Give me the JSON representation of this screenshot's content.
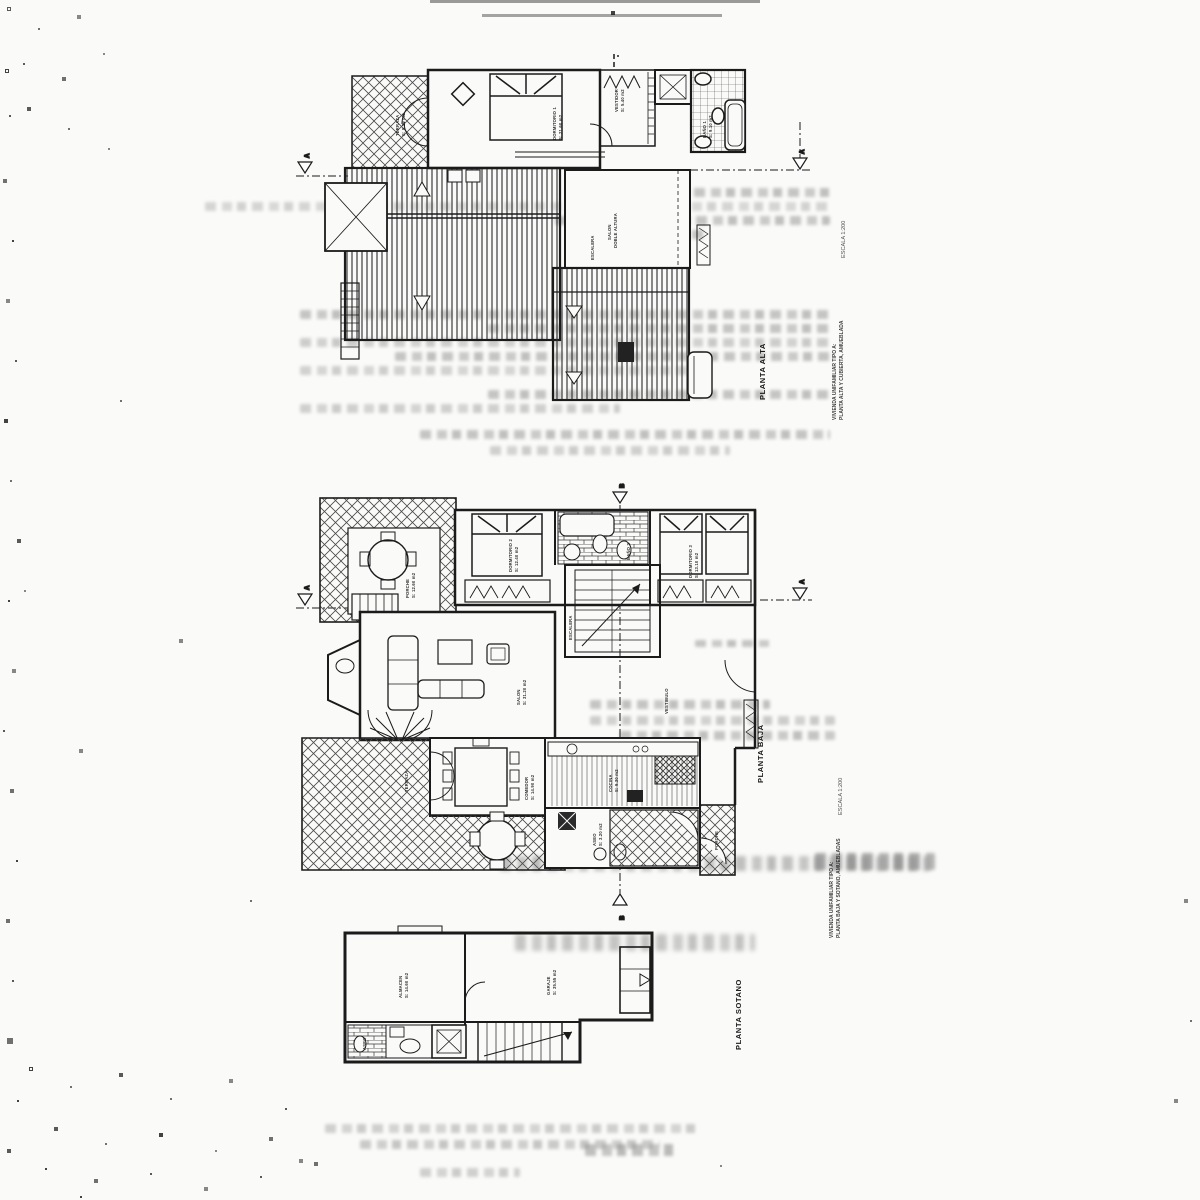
{
  "colors": {
    "ink": "#1b1b1b",
    "paper": "#fafaf8",
    "ghost": "#8f8f8f"
  },
  "markers": {
    "a": "A",
    "b": "B"
  },
  "plans": {
    "alta": {
      "caption": "PLANTA ALTA",
      "escala": "ESCALA 1:200",
      "title1": "VIVIENDA UNIFAMILIAR TIPO A:",
      "title2": "PLANTA ALTA Y CUBIERTA, AMUEBLADA",
      "rooms": {
        "terraza": {
          "name": "TERRAZA",
          "area": "S: 9.20 m2"
        },
        "dormitorio1": {
          "name": "DORMITORIO 1",
          "area": "S: 21.60 m2"
        },
        "vestidor": {
          "name": "VESTIDOR",
          "area": "S: 5.40 m2"
        },
        "bano1": {
          "name": "BAÑO 1",
          "area": "S: 9.10 m2"
        },
        "salon": {
          "name": "SALON",
          "area": "DOBLE ALTURA"
        },
        "escalera": {
          "name": "ESCALERA",
          "area": ""
        }
      }
    },
    "baja": {
      "caption": "PLANTA BAJA",
      "escala": "ESCALA 1:200",
      "title1": "VIVIENDA UNIFAMILIAR TIPO A:",
      "title2": "PLANTA BAJA Y SOTANO, AMUEBLADAS",
      "rooms": {
        "porche": {
          "name": "PORCHE",
          "area": "S: 12.60 m2"
        },
        "dormitorio2": {
          "name": "DORMITORIO 2",
          "area": "S: 12.40 m2"
        },
        "bano2": {
          "name": "BAÑO 2",
          "area": "S: 5.10 m2"
        },
        "dormitorio3": {
          "name": "DORMITORIO 3",
          "area": "S: 13.10 m2"
        },
        "salon": {
          "name": "SALON",
          "area": "S: 31.20 m2"
        },
        "comedor": {
          "name": "COMEDOR",
          "area": "S: 14.90 m2"
        },
        "cocina": {
          "name": "COCINA",
          "area": "S: 9.30 m2"
        },
        "escalera": {
          "name": "ESCALERA",
          "area": ""
        },
        "aseo": {
          "name": "ASEO",
          "area": "S: 3.20 m2"
        },
        "terraza": {
          "name": "TERRAZA",
          "area": ""
        },
        "porche2": {
          "name": "PORCHE",
          "area": ""
        },
        "vestibulo": {
          "name": "VESTIBULO",
          "area": ""
        }
      }
    },
    "sotano": {
      "caption": "PLANTA SOTANO",
      "rooms": {
        "almacen": {
          "name": "ALMACEN",
          "area": "S: 14.60 m2"
        },
        "garaje": {
          "name": "GARAJE",
          "area": "S: 35.55 m2"
        },
        "aseo": {
          "name": "ASEO",
          "area": ""
        }
      }
    }
  }
}
